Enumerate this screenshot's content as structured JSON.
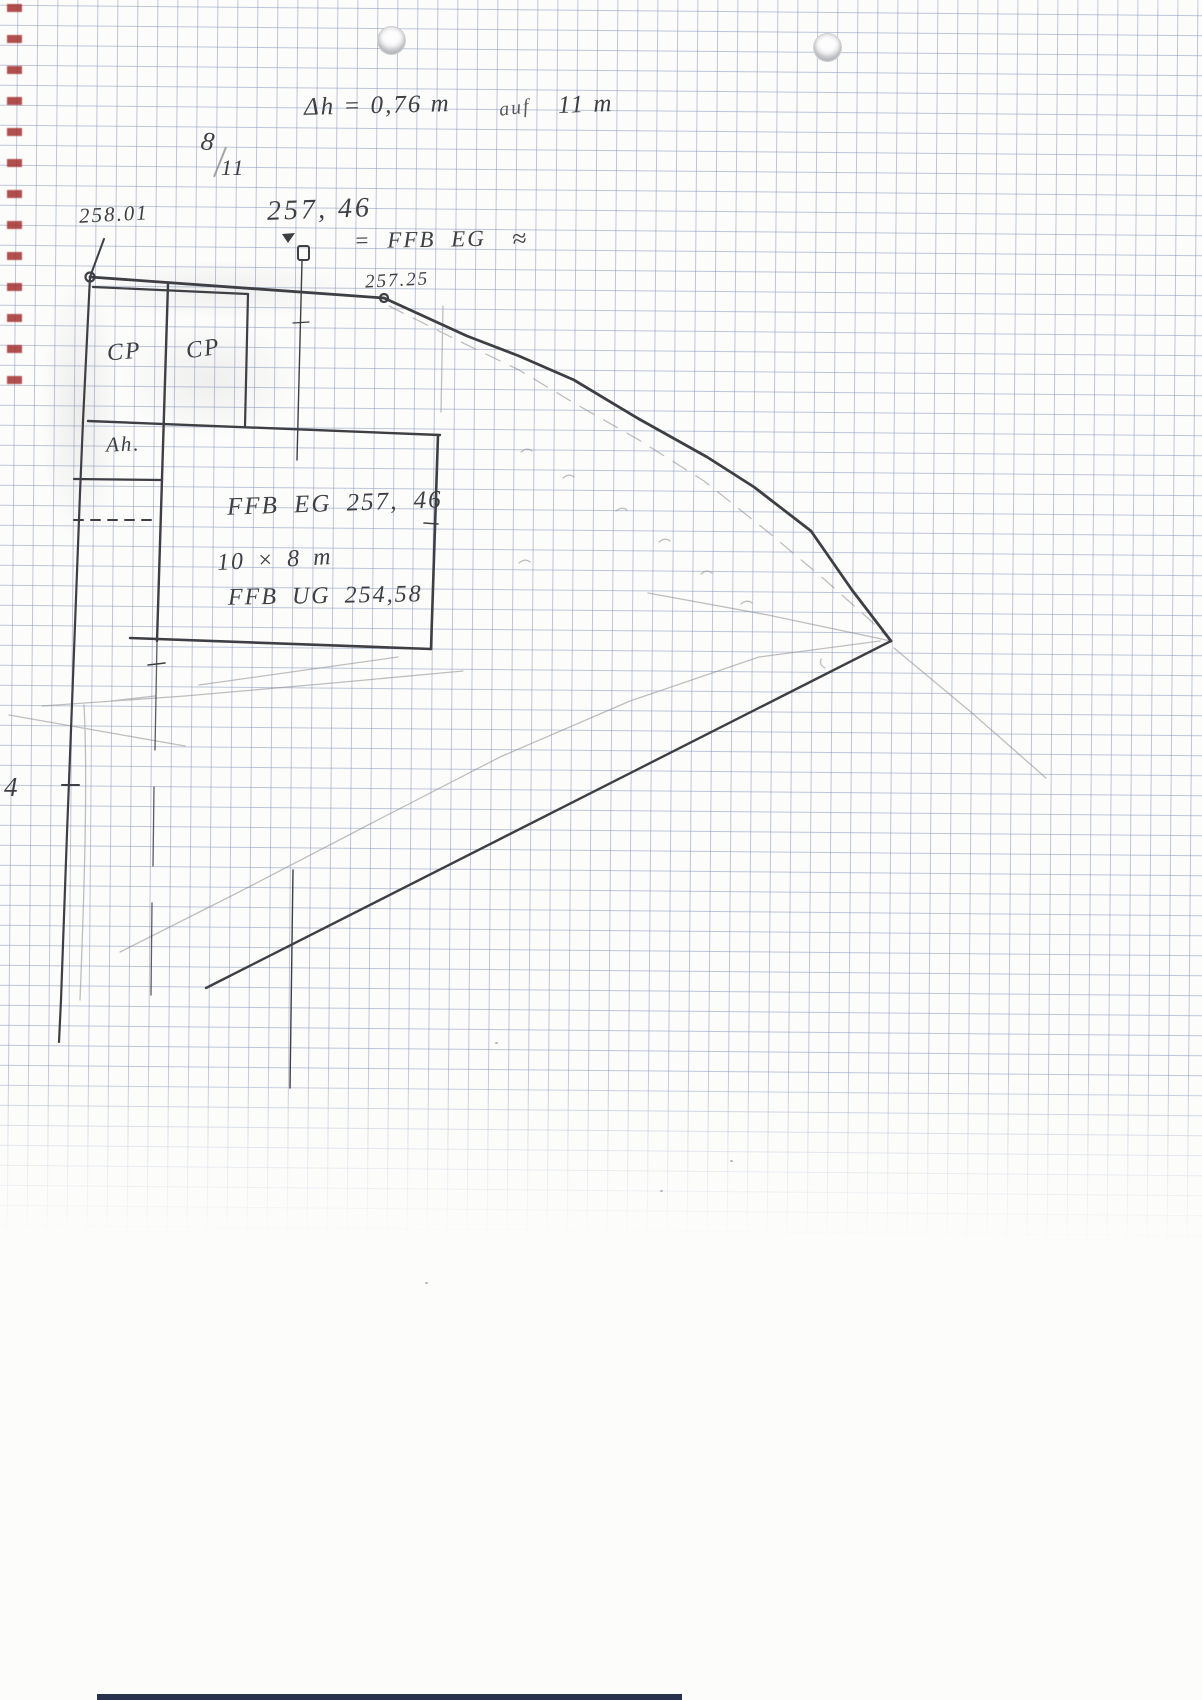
{
  "colors": {
    "ink": "#3e3f44",
    "pencil": "#8d8d93",
    "grid": "rgba(128,143,182,0.5)",
    "red": "#a43131",
    "strip": "#28324e"
  },
  "notes": {
    "delta_h": "Δh = 0,76 m",
    "auf": "auf",
    "span_len": "11 m",
    "frac_num": "8",
    "frac_den": "11"
  },
  "elev": {
    "corner": "258.01",
    "point": "257, 46",
    "eq_ffb": "= FFB EG",
    "approx": "≈",
    "fence": "257.25"
  },
  "carport": {
    "cp1": "CP",
    "cp2": "CP",
    "annex": "Ah."
  },
  "building": {
    "l1": "FFB EG 257, 46",
    "l2": "10 × 8 m",
    "l3": "FFB UG 254,58"
  },
  "margin": {
    "num": "4"
  }
}
